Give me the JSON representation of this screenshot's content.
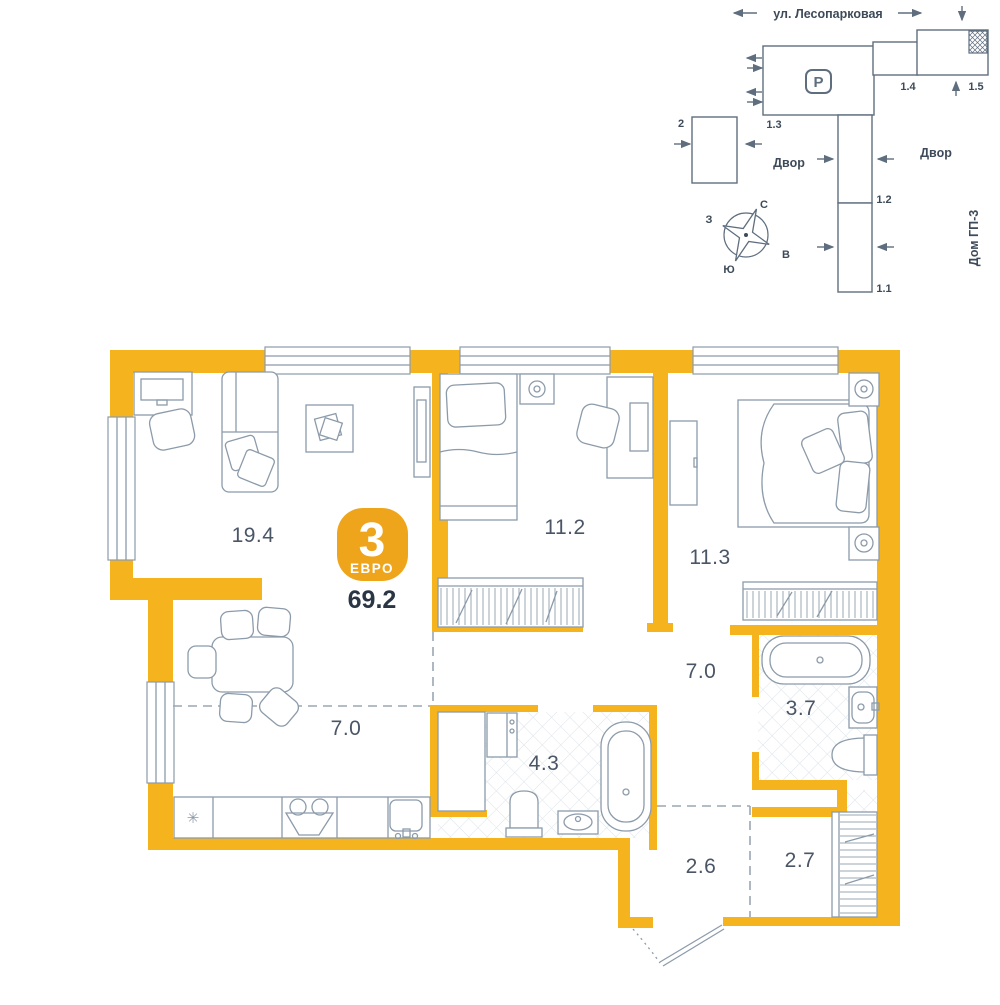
{
  "colors": {
    "wall_yellow": "#F5B41D",
    "badge_yellow": "#EFA51B",
    "line_gray": "#8C9BAA",
    "site_line": "#5F6E7E",
    "text_dark": "#3D4A59",
    "label_gray": "#4A5666",
    "tile_gray": "#DCE3E9",
    "dash_gray": "#9AA7B3",
    "total_dark": "#2B3645"
  },
  "icons": {
    "snowflake": "✳",
    "parking": "P"
  },
  "site_plan": {
    "street": "ул. Лесопарковая",
    "yard1": "Двор",
    "yard2": "Двор",
    "neighbor": "Дом ГП-3",
    "b2": "2",
    "b11": "1.1",
    "b12": "1.2",
    "b13": "1.3",
    "b14": "1.4",
    "b15": "1.5",
    "compass": {
      "n": "С",
      "e": "В",
      "s": "Ю",
      "w": "З"
    }
  },
  "apartment": {
    "badge": {
      "rooms": "3",
      "format": "ЕВРО",
      "total_area": "69.2"
    },
    "areas": {
      "living": "19.4",
      "bedroom1": "11.2",
      "bedroom2": "11.3",
      "kitchen": "7.0",
      "hall": "7.0",
      "bath_main": "4.3",
      "bath_second": "3.7",
      "entry": "2.6",
      "closet": "2.7"
    }
  }
}
